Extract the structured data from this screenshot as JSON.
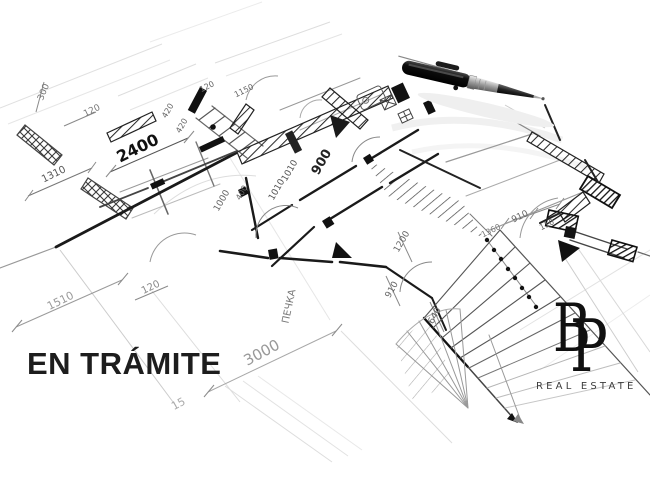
{
  "overlay": {
    "status_text": "EN TRÁMITE"
  },
  "logo": {
    "initial_b": "B",
    "initial_p": "P",
    "subtitle": "REAL ESTATE"
  },
  "colors": {
    "background": "#ffffff",
    "sketch_ink": "#1a1a1a",
    "status_text": "#1d1d1d",
    "logo_text": "#101010",
    "logo_subtitle": "#3d3d3d"
  },
  "decorations": {
    "pen": "ballpoint-pen-photo",
    "sketch": "hand-drawn-floor-plan-perspective"
  },
  "floor_plan": {
    "labels": [
      {
        "text": "300",
        "x": 46,
        "y": 93,
        "rot": -68,
        "size": 9,
        "color": "#777777"
      },
      {
        "text": "120",
        "x": 93,
        "y": 113,
        "rot": -26,
        "size": 9,
        "color": "#777777"
      },
      {
        "text": "1310",
        "x": 55,
        "y": 177,
        "rot": -26,
        "size": 10,
        "color": "#555555"
      },
      {
        "text": "2400",
        "x": 140,
        "y": 153,
        "rot": -26,
        "size": 16,
        "color": "#111111",
        "weight": 700
      },
      {
        "text": "420",
        "x": 170,
        "y": 112,
        "rot": -60,
        "size": 8,
        "color": "#666666"
      },
      {
        "text": "420",
        "x": 184,
        "y": 127,
        "rot": -60,
        "size": 8,
        "color": "#666666"
      },
      {
        "text": "120",
        "x": 208,
        "y": 89,
        "rot": -26,
        "size": 8,
        "color": "#666666"
      },
      {
        "text": "1150",
        "x": 245,
        "y": 93,
        "rot": -26,
        "size": 8,
        "color": "#666666"
      },
      {
        "text": "1000",
        "x": 224,
        "y": 202,
        "rot": -60,
        "size": 9,
        "color": "#666666"
      },
      {
        "text": "400",
        "x": 244,
        "y": 194,
        "rot": -60,
        "size": 8,
        "color": "#666666"
      },
      {
        "text": "1010",
        "x": 292,
        "y": 172,
        "rot": -60,
        "size": 9,
        "color": "#555555"
      },
      {
        "text": "1010",
        "x": 279,
        "y": 191,
        "rot": -60,
        "size": 9,
        "color": "#555555"
      },
      {
        "text": "900",
        "x": 325,
        "y": 164,
        "rot": -60,
        "size": 13,
        "color": "#222222",
        "weight": 700
      },
      {
        "text": "1200",
        "x": 404,
        "y": 243,
        "rot": -60,
        "size": 9,
        "color": "#666666"
      },
      {
        "text": "910",
        "x": 394,
        "y": 291,
        "rot": -60,
        "size": 9,
        "color": "#666666"
      },
      {
        "text": "640",
        "x": 437,
        "y": 317,
        "rot": -60,
        "size": 9,
        "color": "#666666"
      },
      {
        "text": "ПЕЧКА",
        "x": 292,
        "y": 307,
        "rot": -78,
        "size": 10,
        "color": "#777777"
      },
      {
        "text": "3000",
        "x": 264,
        "y": 357,
        "rot": -28,
        "size": 15,
        "color": "#999999"
      },
      {
        "text": "1510",
        "x": 62,
        "y": 304,
        "rot": -26,
        "size": 11,
        "color": "#999999"
      },
      {
        "text": "120",
        "x": 152,
        "y": 290,
        "rot": -26,
        "size": 10,
        "color": "#888888"
      },
      {
        "text": "910",
        "x": 521,
        "y": 219,
        "rot": -26,
        "size": 9,
        "color": "#666666"
      },
      {
        "text": "110",
        "x": 548,
        "y": 227,
        "rot": -26,
        "size": 8,
        "color": "#666666"
      },
      {
        "text": "1360",
        "x": 492,
        "y": 233,
        "rot": -26,
        "size": 8,
        "color": "#777777"
      },
      {
        "text": "15",
        "x": 180,
        "y": 407,
        "rot": -28,
        "size": 11,
        "color": "#aaaaaa"
      }
    ]
  }
}
